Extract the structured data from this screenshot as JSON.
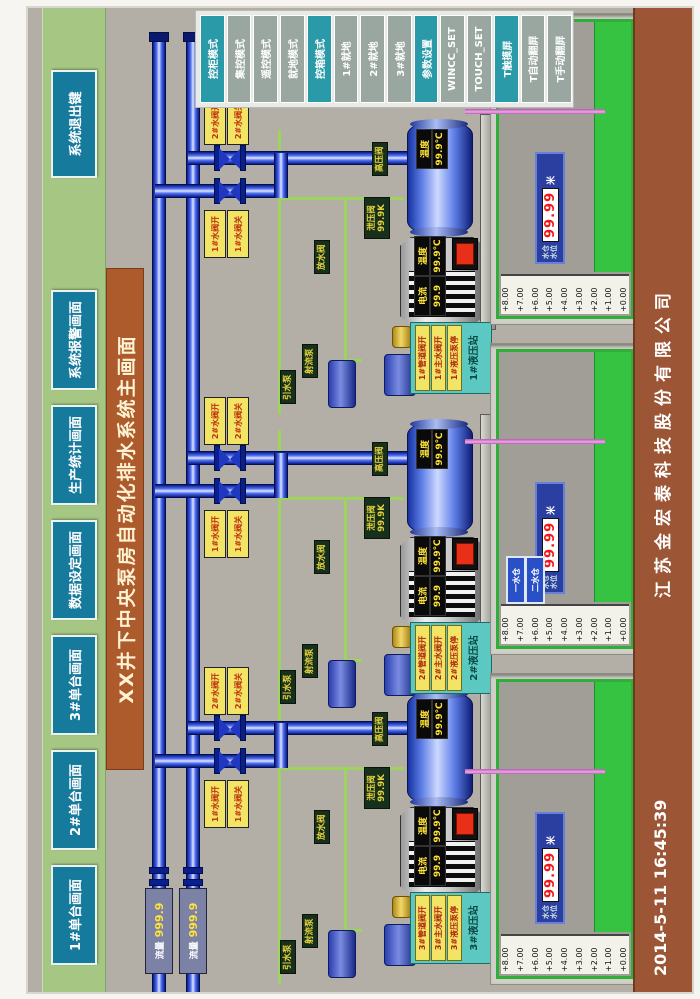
{
  "nav": {
    "buttons": [
      "1#单台画面",
      "2#单台画面",
      "3#单台画面",
      "数据设定画面",
      "生产统计画面",
      "系统报警画面",
      "系统退出键"
    ]
  },
  "title": "XX井下中央泵房自动化排水系统主画面",
  "mode_panel": {
    "buttons": [
      {
        "label": "控柜模式"
      },
      {
        "label": "集控模式"
      },
      {
        "label": "遥控模式"
      },
      {
        "label": "就地模式"
      },
      {
        "label": "控箱模式"
      },
      {
        "label": "1#就地"
      },
      {
        "label": "2#就地"
      },
      {
        "label": "3#就地"
      },
      {
        "label": "参数设置"
      },
      {
        "label": "WINCC_SET"
      },
      {
        "label": "TOUCH_SET"
      },
      {
        "label": "T触摸屏"
      },
      {
        "label": "T自动翻屏"
      },
      {
        "label": "T手动翻屏"
      }
    ]
  },
  "flow_meters": [
    {
      "label": "流量",
      "value": "999.9"
    },
    {
      "label": "流量",
      "value": "999.9"
    }
  ],
  "valve_tags": {
    "upper_open": "2#水阀开",
    "upper_close": "2#水阀关",
    "lower_open": "1#水阀开",
    "lower_close": "1#水阀关"
  },
  "equipment_tags": {
    "hp_valve": "高压阀",
    "relief_valve": "泄压阀",
    "relief_value": "99.9K",
    "drain_valve": "放水阀",
    "jet_pump": "射流泵",
    "prime_pump": "引水泵"
  },
  "readouts": {
    "pump_temp_label": "温度",
    "pump_temp_value": "99.9℃",
    "motor_current_label": "电流",
    "motor_current_value": "99.9",
    "motor_temp_label": "温度",
    "motor_temp_value": "99.9℃"
  },
  "units": [
    {
      "id": "3#",
      "hydraulic": {
        "title": "3#液压站",
        "items": [
          "3#管道阀开",
          "3#主水阀开",
          "3#液压泵停"
        ]
      }
    },
    {
      "id": "2#",
      "hydraulic": {
        "title": "2#液压站",
        "items": [
          "2#管道阀开",
          "2#主水阀开",
          "2#液压泵停"
        ]
      }
    },
    {
      "id": "1#",
      "hydraulic": {
        "title": "1#液压站",
        "items": [
          "1#管道阀开",
          "1#主水阀开",
          "1#液压泵停"
        ]
      }
    }
  ],
  "tank": {
    "scale": [
      "+8.00",
      "+7.00",
      "+6.00",
      "+5.00",
      "+4.00",
      "+3.00",
      "+2.00",
      "+1.00",
      "+0.00"
    ],
    "level_label_1": "水仓",
    "level_label_2": "水位",
    "level_value": "99.99",
    "level_unit": "米"
  },
  "sump_buttons": [
    "一水仓",
    "二水仓"
  ],
  "footer": {
    "datetime": "2014-5-11  16:45:39",
    "company": "江苏金宏泰科技股份有限公司"
  },
  "colors": {
    "accent_teal": "#2a9aa8",
    "panel_brown": "#9c5535",
    "nav_blue": "#157a9c",
    "alarm_red": "#e83018",
    "water_green": "#36c342",
    "pipe_blue": "#2038c0"
  }
}
